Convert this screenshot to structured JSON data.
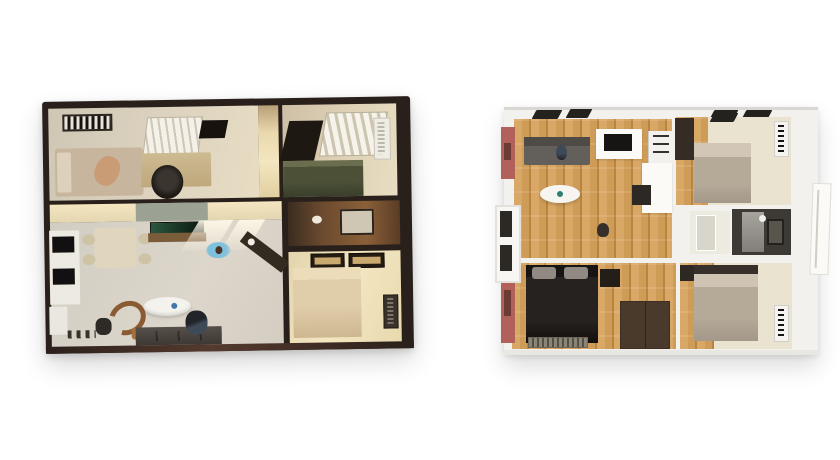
{
  "scene": {
    "description": "Two photorealistic 3D top-down floor plan renderings side by side on a white background",
    "left_plan": {
      "name": "dark-walled two-bedroom apartment render",
      "wall_style": "dark walnut walls with warm cream interiors",
      "rooms": [
        "bedroom-office",
        "entry-hall",
        "second-bedroom",
        "bathroom",
        "third-bedroom",
        "open-living-dining-kitchen"
      ],
      "furniture": [
        "air-conditioner",
        "double-bed",
        "window-blinds",
        "desk",
        "office-chair",
        "green-bed",
        "wall-ac-unit",
        "vanity-mirror",
        "beige-bed",
        "picture-frames",
        "kitchen-cabinets",
        "dining-table",
        "tv",
        "media-console",
        "oval-lounger",
        "round-rattan-chair",
        "dark-sofa",
        "console-table-with-lamp"
      ],
      "people_count": 4
    },
    "right_plan": {
      "name": "white-walled three-bedroom container-home render",
      "wall_style": "white walls, terracotta exterior accents, oak plank flooring",
      "rooms": [
        "living-room",
        "kitchen",
        "master-bedroom",
        "hallway-laundry",
        "bathroom",
        "second-bedroom",
        "third-bedroom"
      ],
      "furniture": [
        "gray-sectional-sofa",
        "oval-coffee-table",
        "cooktop-counter",
        "fridge",
        "counter-column",
        "grill-island",
        "wardrobe",
        "taupe-bed",
        "wall-ac-unit",
        "shower-glass",
        "mirror",
        "dark-bed",
        "nightstand",
        "brown-wardrobe",
        "floor-vent",
        "fold-out-door-panels"
      ],
      "people_count": 2
    }
  },
  "colors": {
    "page_bg": "#ffffff",
    "lp_wall": "#2a201b",
    "lp_base_brown": "#553a2e",
    "lp_floor_warm": "#ddd3c0",
    "lp_floor_living": "#dcd6cb",
    "lp_cream": "#e8ddc2",
    "lp_glow": "#f3e6c0",
    "lp_green_bed": "#4b5037",
    "lp_bed_beige": "#c8b59e",
    "lp_desk": "#cdbb92",
    "lp_dark": "#17120d",
    "lp_sofa": "#3e3833",
    "lp_brown_chair": "#8a5a33",
    "lp_bath_wood": "#6b4a2e",
    "lp_sage": "#9ba294",
    "rp_wall": "#f2f1ed",
    "rp_wood": "#cf9c58",
    "rp_wood_light": "#d9a866",
    "rp_wood_dark": "#b9843f",
    "rp_cream": "#e9e3cf",
    "rp_sofa_gray": "#63605c",
    "rp_white": "#fbfaf7",
    "rp_black": "#161513",
    "rp_pink": "#b2615a",
    "rp_bed_dark": "#262220",
    "rp_pillow_gray": "#918a82",
    "rp_bed_taupe": "#b5a997",
    "rp_bath_dark": "#3d3a36",
    "rp_wood_wardrobe": "#4a3a2c",
    "skin": "#c99c76",
    "denim": "#3f4a58",
    "toy_blue": "#7fc0dc"
  }
}
